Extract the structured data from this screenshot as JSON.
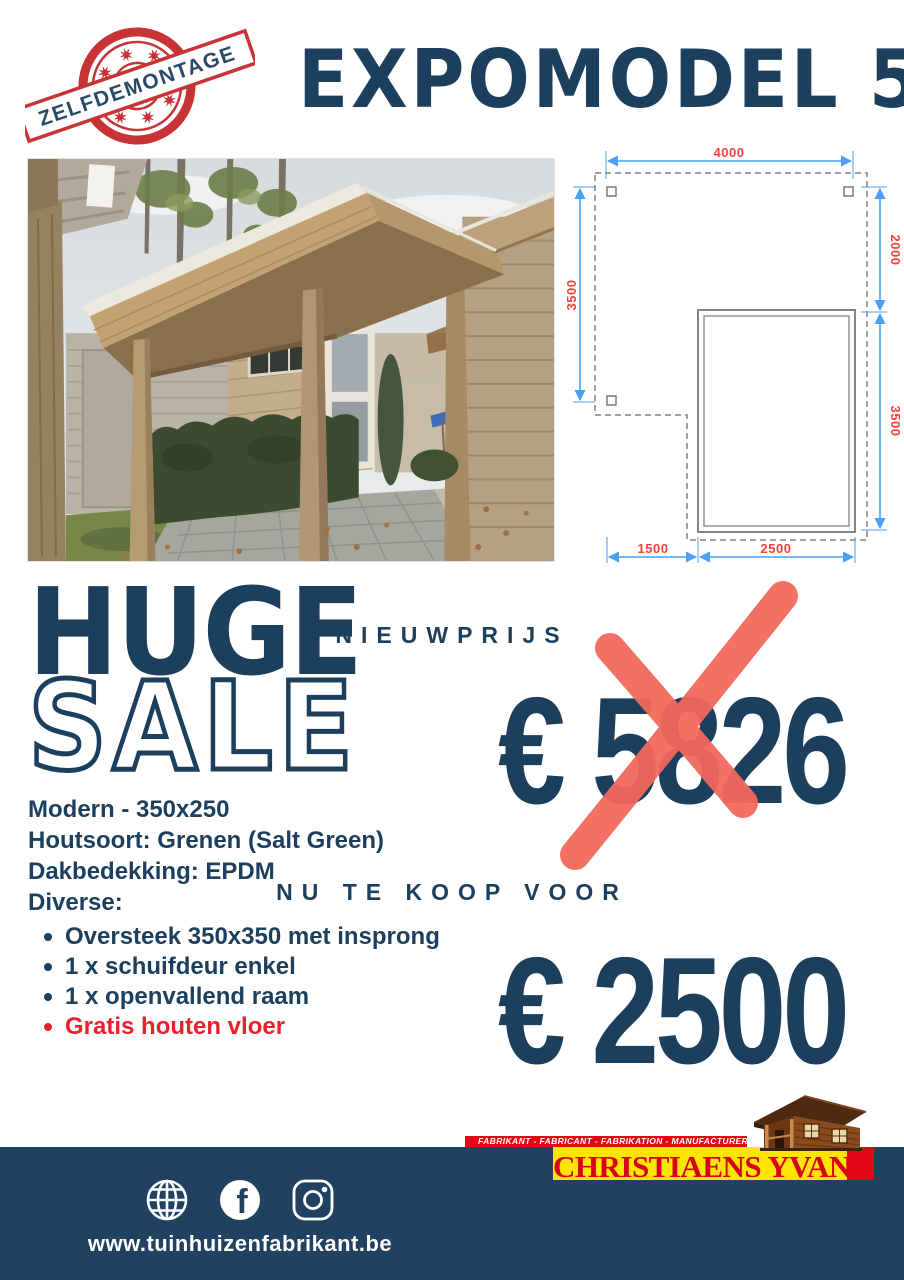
{
  "stamp": {
    "text": "ZELFDEMONTAGE"
  },
  "header": {
    "title": "EXPOMODEL 5"
  },
  "photo": {
    "alt": "Wooden garden house with flat roof canopy, paved terrace, hedge and lawn"
  },
  "diagram": {
    "top": "4000",
    "right_upper": "2000",
    "left": "3500",
    "right_lower": "3500",
    "bottom_left": "1500",
    "bottom_right": "2500"
  },
  "sale": {
    "word1": "HUGE",
    "word2": "SALE"
  },
  "specs": {
    "lines": [
      "Modern - 350x250",
      "Houtsoort: Grenen (Salt Green)",
      "Dakbedekking: EPDM",
      "Diverse:"
    ],
    "bullets": [
      {
        "text": "Oversteek 350x350 met insprong",
        "highlight": false
      },
      {
        "text": "1 x schuifdeur enkel",
        "highlight": false
      },
      {
        "text": "1 x openvallend raam",
        "highlight": false
      },
      {
        "text": "Gratis houten vloer",
        "highlight": true
      }
    ]
  },
  "pricing": {
    "old_label": "NIEUWPRIJS",
    "old_price": "€ 5826",
    "new_label": "NU TE KOOP VOOR",
    "new_price": "€ 2500"
  },
  "brand": {
    "strip": "FABRIKANT - FABRICANT - FABRIKATION - MANUFACTURER",
    "name": "CHRISTIAENS YVAN",
    "reg": "®"
  },
  "footer": {
    "url": "www.tuinhuizenfabrikant.be",
    "icons": [
      "globe-icon",
      "facebook-icon",
      "instagram-icon"
    ]
  },
  "colors": {
    "navy": "#1c3f5e",
    "red": "#e8212a",
    "salmon_x": "#f2695c",
    "stamp_red": "#c5272a",
    "dim_blue": "#4aa0f2",
    "dim_red": "#f5413d",
    "brand_red": "#e30615",
    "brand_yellow": "#ffe400",
    "footer_navy": "#20415f"
  }
}
